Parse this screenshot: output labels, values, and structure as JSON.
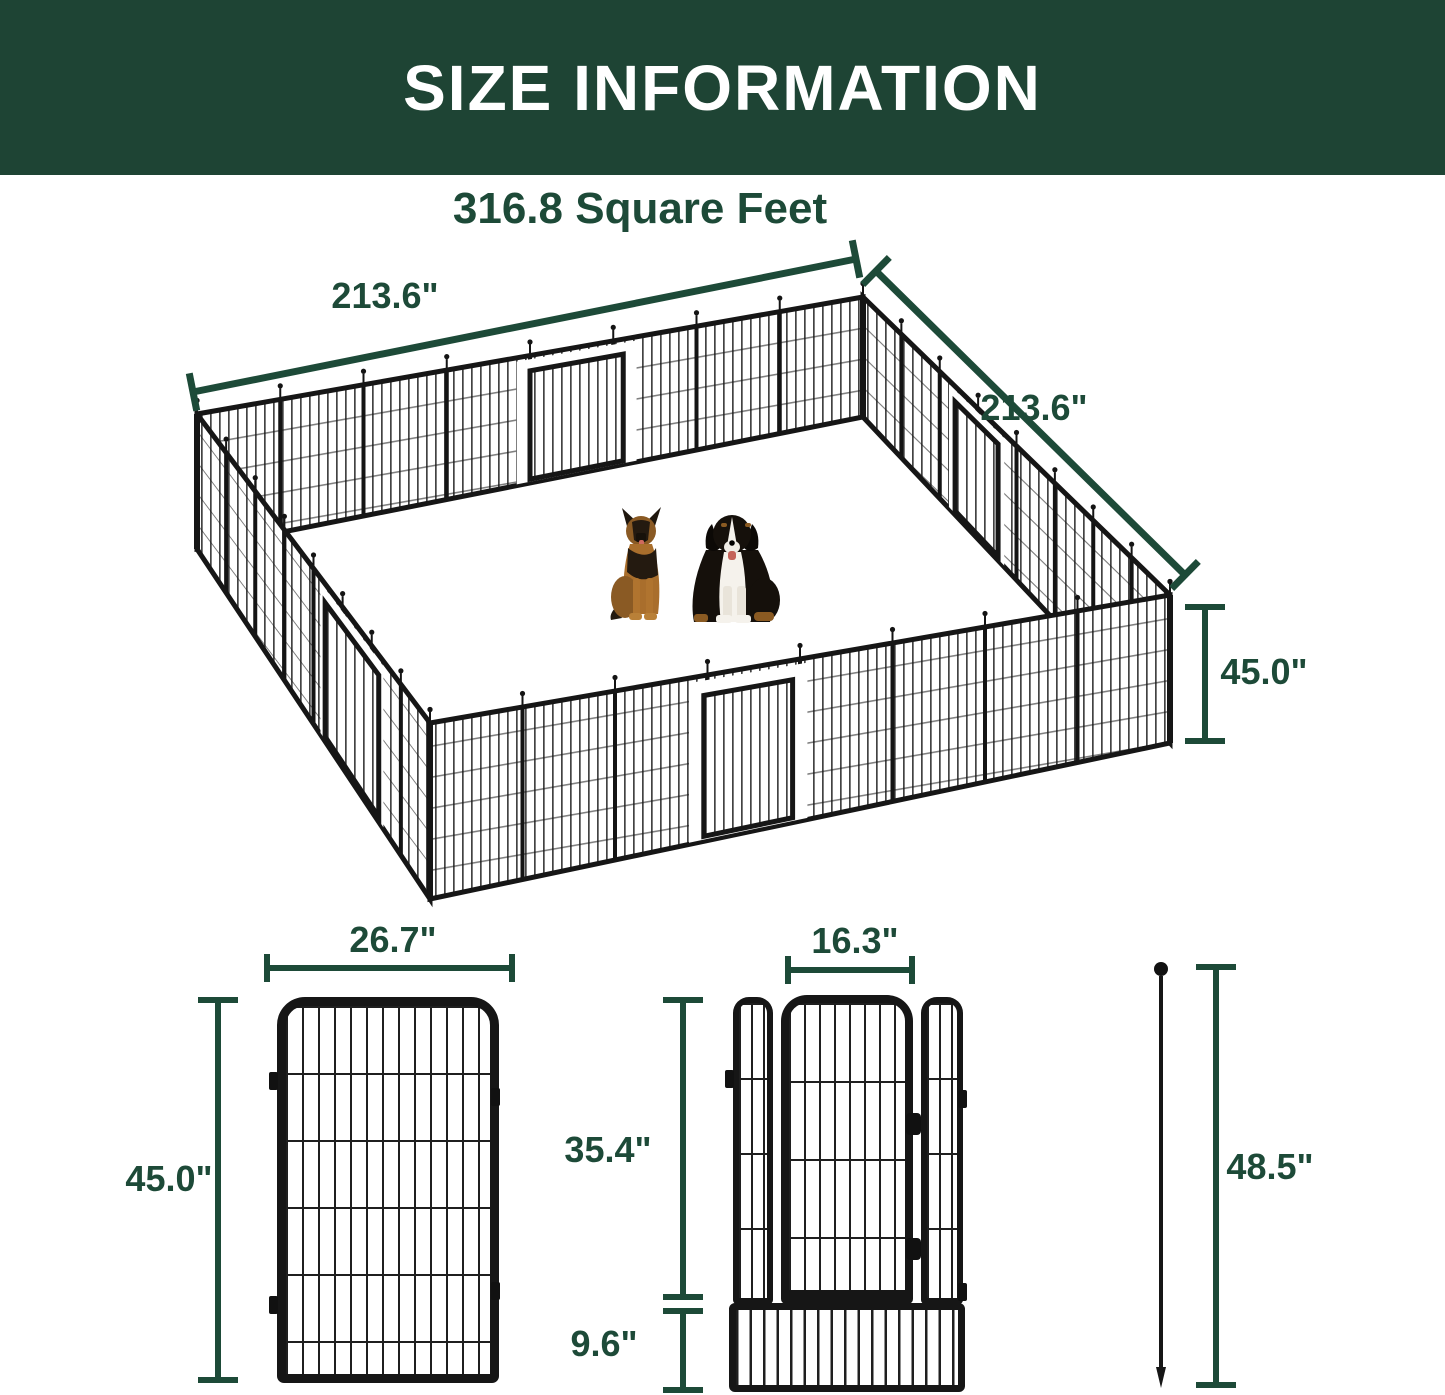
{
  "header": {
    "title": "SIZE INFORMATION"
  },
  "area": {
    "label": "316.8 Square Feet"
  },
  "pen": {
    "width_label": "213.6\"",
    "depth_label": "213.6\"",
    "height_label": "45.0\""
  },
  "panel": {
    "width_label": "26.7\"",
    "height_label": "45.0\""
  },
  "gate": {
    "door_width_label": "16.3\"",
    "upper_height_label": "35.4\"",
    "lower_height_label": "9.6\""
  },
  "stake": {
    "height_label": "48.5\""
  },
  "colors": {
    "header_bg": "#1e4434",
    "accent": "#1d4a38",
    "metal": "#161616"
  }
}
